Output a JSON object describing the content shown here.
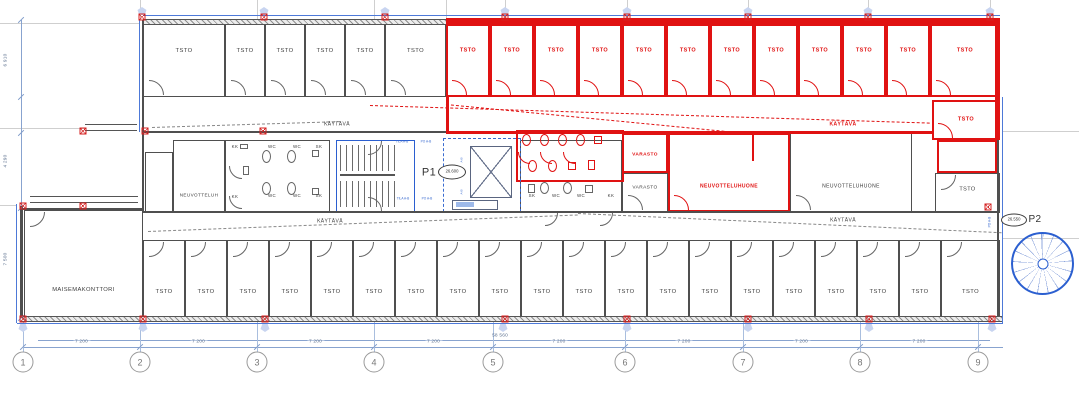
{
  "title": "floor-plan-level-p1",
  "colors": {
    "red": "#e01212",
    "blue": "#3a6bd0",
    "wall": "#4f4f4f",
    "dim": "#88a3cf"
  },
  "cores": {
    "p1": {
      "label": "P1",
      "level": "26.600"
    },
    "p2": {
      "label": "P2",
      "level": "26.550"
    }
  },
  "grid": {
    "xs": [
      23,
      140,
      257,
      374,
      493,
      625,
      743,
      860,
      978
    ],
    "labels": [
      "1",
      "2",
      "3",
      "4",
      "5",
      "6",
      "7",
      "8",
      "9"
    ],
    "bay_dim": "7 200",
    "total": "58 560",
    "bubble_y": 362,
    "chain_y": 347,
    "dim_label_y": 343,
    "total_pos": [
      500,
      337
    ]
  },
  "left_dims": [
    {
      "label": "6 910",
      "x": 7,
      "y": 60
    },
    {
      "label": "4 290",
      "x": 7,
      "y": 161
    },
    {
      "label": "7 500",
      "x": 7,
      "y": 259
    }
  ],
  "left_ticks": [
    20,
    97,
    133,
    208,
    318
  ],
  "rooms": [
    [
      143,
      24,
      82,
      73,
      "TSTO",
      "k",
      "b",
      52,
      5.8
    ],
    [
      225,
      24,
      40,
      73,
      "TSTO",
      "k",
      "b",
      52,
      5.8
    ],
    [
      265,
      24,
      40,
      73,
      "TSTO",
      "k",
      "b",
      52,
      5.8
    ],
    [
      305,
      24,
      40,
      73,
      "TSTO",
      "k",
      "b",
      52,
      5.8
    ],
    [
      345,
      24,
      40,
      73,
      "TSTO",
      "k",
      "b",
      52,
      5.8
    ],
    [
      385,
      24,
      61,
      73,
      "TSTO",
      "k",
      "b",
      52,
      5.8
    ],
    [
      446,
      24,
      44,
      73,
      "TSTO",
      "r",
      "b",
      51,
      5.5
    ],
    [
      490,
      24,
      44,
      73,
      "TSTO",
      "r",
      "b",
      51,
      5.5
    ],
    [
      534,
      24,
      44,
      73,
      "TSTO",
      "r",
      "b",
      51,
      5.5
    ],
    [
      578,
      24,
      44,
      73,
      "TSTO",
      "r",
      "b",
      51,
      5.5
    ],
    [
      622,
      24,
      44,
      73,
      "TSTO",
      "r",
      "b",
      51,
      5.5
    ],
    [
      666,
      24,
      44,
      73,
      "TSTO",
      "r",
      "b",
      51,
      5.5
    ],
    [
      710,
      24,
      44,
      73,
      "TSTO",
      "r",
      "b",
      51,
      5.5
    ],
    [
      754,
      24,
      44,
      73,
      "TSTO",
      "r",
      "b",
      51,
      5.5
    ],
    [
      798,
      24,
      44,
      73,
      "TSTO",
      "r",
      "b",
      51,
      5.5
    ],
    [
      842,
      24,
      44,
      73,
      "TSTO",
      "r",
      "b",
      51,
      5.5
    ],
    [
      886,
      24,
      44,
      73,
      "TSTO",
      "r",
      "b",
      51,
      5.5
    ],
    [
      930,
      24,
      70,
      73,
      "TSTO",
      "r",
      "b",
      51,
      5.5
    ],
    [
      24,
      210,
      119,
      108,
      "MAISEMAKONTTORI",
      "k",
      "t",
      291,
      5.8
    ],
    [
      143,
      240,
      42,
      78,
      "TSTO",
      "k",
      "t",
      293,
      5.8
    ],
    [
      185,
      240,
      42,
      78,
      "TSTO",
      "k",
      "t",
      293,
      5.8
    ],
    [
      227,
      240,
      42,
      78,
      "TSTO",
      "k",
      "t",
      293,
      5.8
    ],
    [
      269,
      240,
      42,
      78,
      "TSTO",
      "k",
      "t",
      293,
      5.8
    ],
    [
      311,
      240,
      42,
      78,
      "TSTO",
      "k",
      "t",
      293,
      5.8
    ],
    [
      353,
      240,
      42,
      78,
      "TSTO",
      "k",
      "t",
      293,
      5.8
    ],
    [
      395,
      240,
      42,
      78,
      "TSTO",
      "k",
      "t",
      293,
      5.8
    ],
    [
      437,
      240,
      42,
      78,
      "TSTO",
      "k",
      "t",
      293,
      5.8
    ],
    [
      479,
      240,
      42,
      78,
      "TSTO",
      "k",
      "t",
      293,
      5.8
    ],
    [
      521,
      240,
      42,
      78,
      "TSTO",
      "k",
      "t",
      293,
      5.8
    ],
    [
      563,
      240,
      42,
      78,
      "TSTO",
      "k",
      "t",
      293,
      5.8
    ],
    [
      605,
      240,
      42,
      78,
      "TSTO",
      "k",
      "t",
      293,
      5.8
    ],
    [
      647,
      240,
      42,
      78,
      "TSTO",
      "k",
      "t",
      293,
      5.8
    ],
    [
      689,
      240,
      42,
      78,
      "TSTO",
      "k",
      "t",
      293,
      5.8
    ],
    [
      731,
      240,
      42,
      78,
      "TSTO",
      "k",
      "t",
      293,
      5.8
    ],
    [
      773,
      240,
      42,
      78,
      "TSTO",
      "k",
      "t",
      293,
      5.8
    ],
    [
      815,
      240,
      42,
      78,
      "TSTO",
      "k",
      "t",
      293,
      5.8
    ],
    [
      857,
      240,
      42,
      78,
      "TSTO",
      "k",
      "t",
      293,
      5.8
    ],
    [
      899,
      240,
      42,
      78,
      "TSTO",
      "k",
      "t",
      293,
      5.8
    ],
    [
      941,
      240,
      59,
      78,
      "TSTO",
      "k",
      "t",
      293,
      5.8
    ],
    [
      145,
      152,
      28,
      60,
      "",
      "k",
      "",
      0,
      0
    ],
    [
      173,
      140,
      52,
      72,
      "NEUVOTTELUH",
      "k",
      "",
      196,
      4.6
    ],
    [
      225,
      140,
      105,
      72,
      "",
      "k",
      "",
      0,
      0
    ],
    [
      520,
      140,
      102,
      72,
      "",
      "k",
      "",
      0,
      0
    ],
    [
      622,
      173,
      46,
      39,
      "VARASTO",
      "k",
      "b",
      189,
      4.8
    ],
    [
      790,
      133,
      122,
      79,
      "NEUVOTTELUHUONE",
      "k",
      "b",
      187,
      5
    ],
    [
      935,
      173,
      65,
      39,
      "TSTO",
      "k",
      "t",
      190,
      5.5
    ],
    [
      622,
      133,
      46,
      40,
      "VARASTO",
      "r",
      "",
      156,
      4.8
    ],
    [
      668,
      133,
      122,
      79,
      "NEUVOTTELUHUONE",
      "r",
      "b",
      187,
      5
    ],
    [
      932,
      100,
      68,
      40,
      "TSTO",
      "r",
      "b",
      120,
      5.5
    ],
    [
      937,
      140,
      60,
      33,
      "",
      "r",
      "",
      0,
      0
    ],
    [
      516,
      130,
      108,
      52,
      "",
      "r",
      "",
      0,
      0
    ]
  ],
  "texts": [
    [
      "KÄYTÄVÄ",
      337,
      125,
      5,
      "k",
      0
    ],
    [
      "KÄYTÄVÄ",
      843,
      125,
      5,
      "r",
      0
    ],
    [
      "KÄYTÄVÄ",
      330,
      222,
      5,
      "k",
      0
    ],
    [
      "KÄYTÄVÄ",
      843,
      221,
      5,
      "k",
      0
    ],
    [
      "KK",
      235,
      147,
      4.4,
      "k",
      0
    ],
    [
      "WC",
      272,
      147,
      4.4,
      "k",
      0
    ],
    [
      "WC",
      297,
      147,
      4.4,
      "k",
      0
    ],
    [
      "SK",
      319,
      147,
      4.4,
      "k",
      0
    ],
    [
      "KK",
      235,
      197,
      4.4,
      "k",
      0
    ],
    [
      "WC",
      272,
      196,
      4.4,
      "k",
      0
    ],
    [
      "WC",
      297,
      196,
      4.4,
      "k",
      0
    ],
    [
      "SK",
      319,
      196,
      4.4,
      "k",
      0
    ],
    [
      "SK",
      532,
      196,
      4.4,
      "k",
      0
    ],
    [
      "WC",
      556,
      196,
      4.4,
      "k",
      0
    ],
    [
      "WC",
      581,
      196,
      4.4,
      "k",
      0
    ],
    [
      "KK",
      611,
      196,
      4.4,
      "k",
      0
    ],
    [
      "TILA A-B",
      402,
      142,
      3.2,
      "b",
      0
    ],
    [
      "PO A-B",
      426,
      142,
      3.2,
      "b",
      0
    ],
    [
      "TILA A-B",
      403,
      199,
      3.2,
      "b",
      0
    ],
    [
      "PO A-B",
      427,
      199,
      3.2,
      "b",
      0
    ],
    [
      "A-B",
      462,
      160,
      3,
      "b",
      -90
    ],
    [
      "A-B",
      462,
      192,
      3,
      "b",
      -90
    ],
    [
      "PO A-B",
      990,
      222,
      3.2,
      "b",
      -90
    ]
  ],
  "walls": [
    [
      "hatch",
      143,
      19,
      303,
      6
    ],
    [
      "red",
      446,
      18,
      554,
      7
    ],
    [
      "red",
      995,
      25,
      5,
      115
    ],
    [
      "gray",
      142,
      20,
      2,
      193
    ],
    [
      "gray",
      997,
      140,
      2,
      178
    ],
    [
      "hatch",
      20,
      316,
      982,
      6
    ],
    [
      "gray",
      20,
      206,
      3,
      112
    ],
    [
      "gray",
      22,
      208,
      121,
      2
    ],
    [
      "gray",
      143,
      131,
      303,
      2
    ],
    [
      "red",
      446,
      131,
      486,
      2.5
    ],
    [
      "gray",
      143,
      211,
      857,
      1.5
    ],
    [
      "red",
      446,
      97,
      2.5,
      36
    ],
    [
      "red",
      752,
      133,
      2,
      28
    ],
    [
      "blue",
      143,
      15,
      857,
      1
    ],
    [
      "blue",
      139,
      20,
      1,
      112
    ],
    [
      "blue",
      1002,
      97,
      1,
      227
    ],
    [
      "blue",
      16,
      204,
      1,
      119
    ],
    [
      "blue",
      17,
      323,
      986,
      1
    ],
    [
      "wbox",
      452,
      200,
      46,
      10
    ],
    [
      "bluechip",
      456,
      202,
      18,
      5
    ]
  ],
  "guides_h": [
    [
      0,
      23,
      140
    ],
    [
      0,
      128,
      85
    ],
    [
      0,
      205,
      16
    ],
    [
      1003,
      131,
      76
    ],
    [
      1003,
      238,
      76
    ]
  ],
  "guides_v_xs": [
    140,
    257,
    374,
    446,
    505,
    627,
    748,
    868,
    990
  ],
  "markers": [
    [
      142,
      17
    ],
    [
      264,
      17
    ],
    [
      385,
      17
    ],
    [
      505,
      17
    ],
    [
      627,
      17
    ],
    [
      748,
      17
    ],
    [
      868,
      17
    ],
    [
      990,
      17
    ],
    [
      23,
      319
    ],
    [
      143,
      319
    ],
    [
      265,
      319
    ],
    [
      505,
      319
    ],
    [
      627,
      319
    ],
    [
      748,
      319
    ],
    [
      869,
      319
    ],
    [
      992,
      319
    ],
    [
      83,
      131
    ],
    [
      145,
      131
    ],
    [
      263,
      131
    ],
    [
      23,
      206
    ],
    [
      83,
      206
    ],
    [
      988,
      207
    ]
  ],
  "pent_top": {
    "y": 11,
    "xs": [
      142,
      264,
      385,
      505,
      627,
      748,
      868,
      990
    ]
  },
  "pent_bot": {
    "y": 328,
    "xs": [
      23,
      143,
      265,
      503,
      627,
      748,
      869,
      992
    ]
  },
  "dashes": [
    [
      370,
      105,
      560,
      1.8,
      "r"
    ],
    [
      446,
      104,
      300,
      5.5,
      "r"
    ],
    [
      148,
      231,
      430,
      -2.2,
      "k"
    ],
    [
      578,
      213,
      424,
      2.6,
      "k"
    ],
    [
      152,
      127,
      188,
      -1.8,
      "k"
    ]
  ],
  "fixtures": [
    [
      240,
      144,
      8,
      5,
      "k",
      "rect"
    ],
    [
      262,
      150,
      9,
      13,
      "k",
      "oval"
    ],
    [
      287,
      150,
      9,
      13,
      "k",
      "oval"
    ],
    [
      262,
      182,
      9,
      13,
      "k",
      "oval"
    ],
    [
      287,
      182,
      9,
      13,
      "k",
      "oval"
    ],
    [
      243,
      166,
      6,
      9,
      "k",
      "rect"
    ],
    [
      312,
      150,
      7,
      7,
      "k",
      "rect"
    ],
    [
      312,
      188,
      7,
      7,
      "k",
      "rect"
    ],
    [
      540,
      182,
      9,
      12,
      "k",
      "oval"
    ],
    [
      563,
      182,
      9,
      12,
      "k",
      "oval"
    ],
    [
      585,
      185,
      8,
      8,
      "k",
      "rect"
    ],
    [
      528,
      184,
      7,
      9,
      "k",
      "rect"
    ],
    [
      522,
      134,
      9,
      12,
      "r",
      "oval"
    ],
    [
      540,
      134,
      9,
      12,
      "r",
      "oval"
    ],
    [
      558,
      134,
      9,
      12,
      "r",
      "oval"
    ],
    [
      576,
      134,
      9,
      12,
      "r",
      "oval"
    ],
    [
      594,
      136,
      8,
      8,
      "r",
      "rect"
    ],
    [
      528,
      160,
      9,
      12,
      "r",
      "oval"
    ],
    [
      548,
      160,
      9,
      12,
      "r",
      "oval"
    ],
    [
      568,
      162,
      8,
      8,
      "r",
      "rect"
    ],
    [
      588,
      160,
      7,
      10,
      "r",
      "rect"
    ]
  ],
  "extra_doors": [
    [
      242,
      166,
      180,
      "k",
      26
    ],
    [
      242,
      196,
      180,
      "k",
      26
    ],
    [
      368,
      141,
      90,
      "k",
      28
    ],
    [
      368,
      211,
      0,
      "k",
      28
    ],
    [
      530,
      152,
      180,
      "r",
      24
    ],
    [
      552,
      152,
      180,
      "r",
      24
    ],
    [
      575,
      152,
      180,
      "r",
      24
    ],
    [
      545,
      213,
      90,
      "k",
      26
    ],
    [
      600,
      213,
      90,
      "k",
      26
    ]
  ]
}
